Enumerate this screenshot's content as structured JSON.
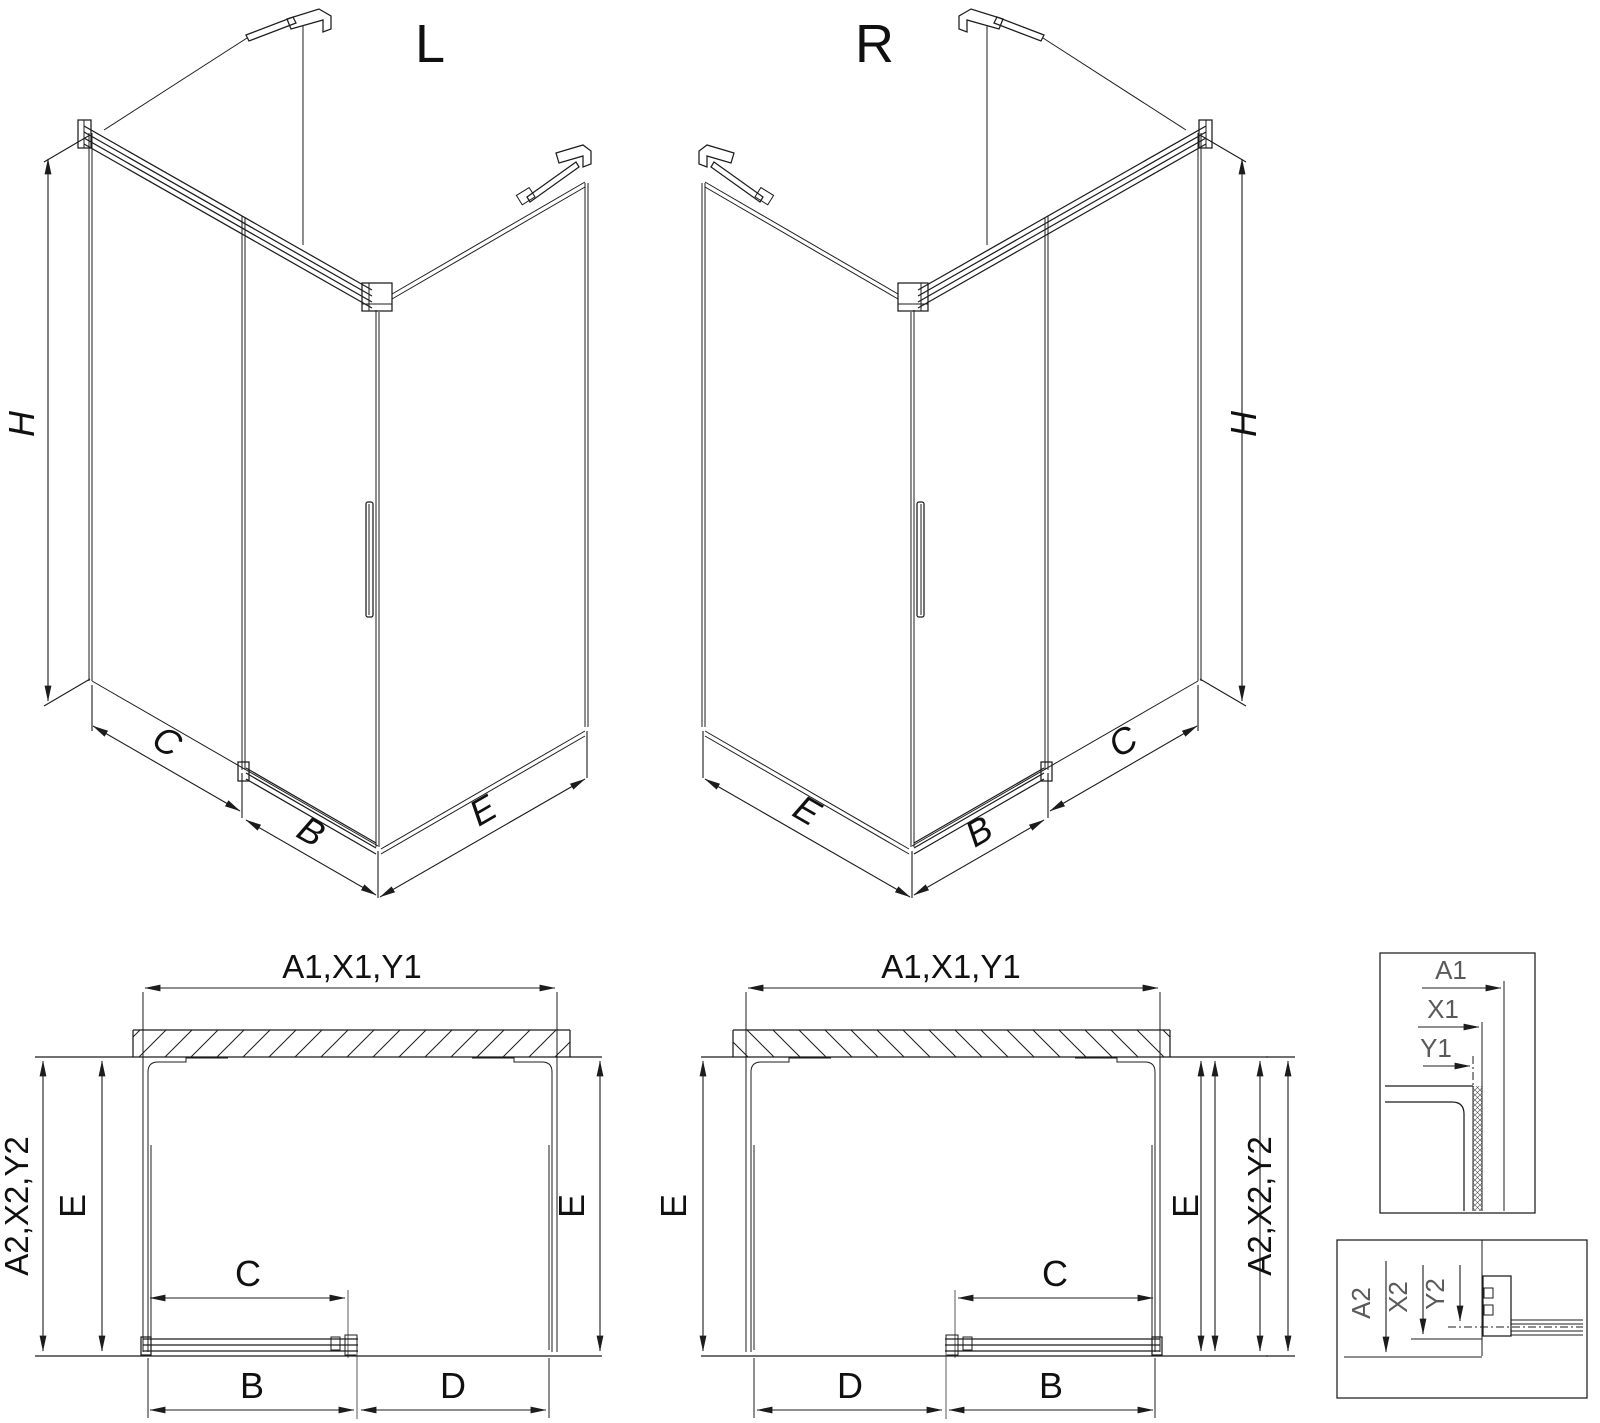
{
  "page": {
    "background": "#ffffff",
    "line_color": "#1c1c1c",
    "dim_label_color": "#101010",
    "detail_label_color": "#5a5a5a",
    "ext_line_color": "#8a8a8a"
  },
  "iso_left": {
    "title": "L",
    "height": "H",
    "fixed_panel": "C",
    "door": "B",
    "side_panel": "E"
  },
  "iso_right": {
    "title": "R",
    "height": "H",
    "fixed_panel": "C",
    "door": "B",
    "side_panel": "E"
  },
  "plan_left": {
    "top_width": "A1,X1,Y1",
    "side_width": "A2,X2,Y2",
    "depth_left": "E",
    "depth_right": "E",
    "clear_opening": "C",
    "door": "B",
    "fixed_panel": "D"
  },
  "plan_right": {
    "top_width": "A1,X1,Y1",
    "side_width": "A2,X2,Y2",
    "depth_left": "E",
    "depth_right": "E",
    "clear_opening": "C",
    "door": "B",
    "fixed_panel": "D"
  },
  "detail_top_right": {
    "a1": "A1",
    "x1": "X1",
    "y1": "Y1"
  },
  "detail_bottom_right": {
    "a2": "A2",
    "x2": "X2",
    "y2": "Y2"
  }
}
